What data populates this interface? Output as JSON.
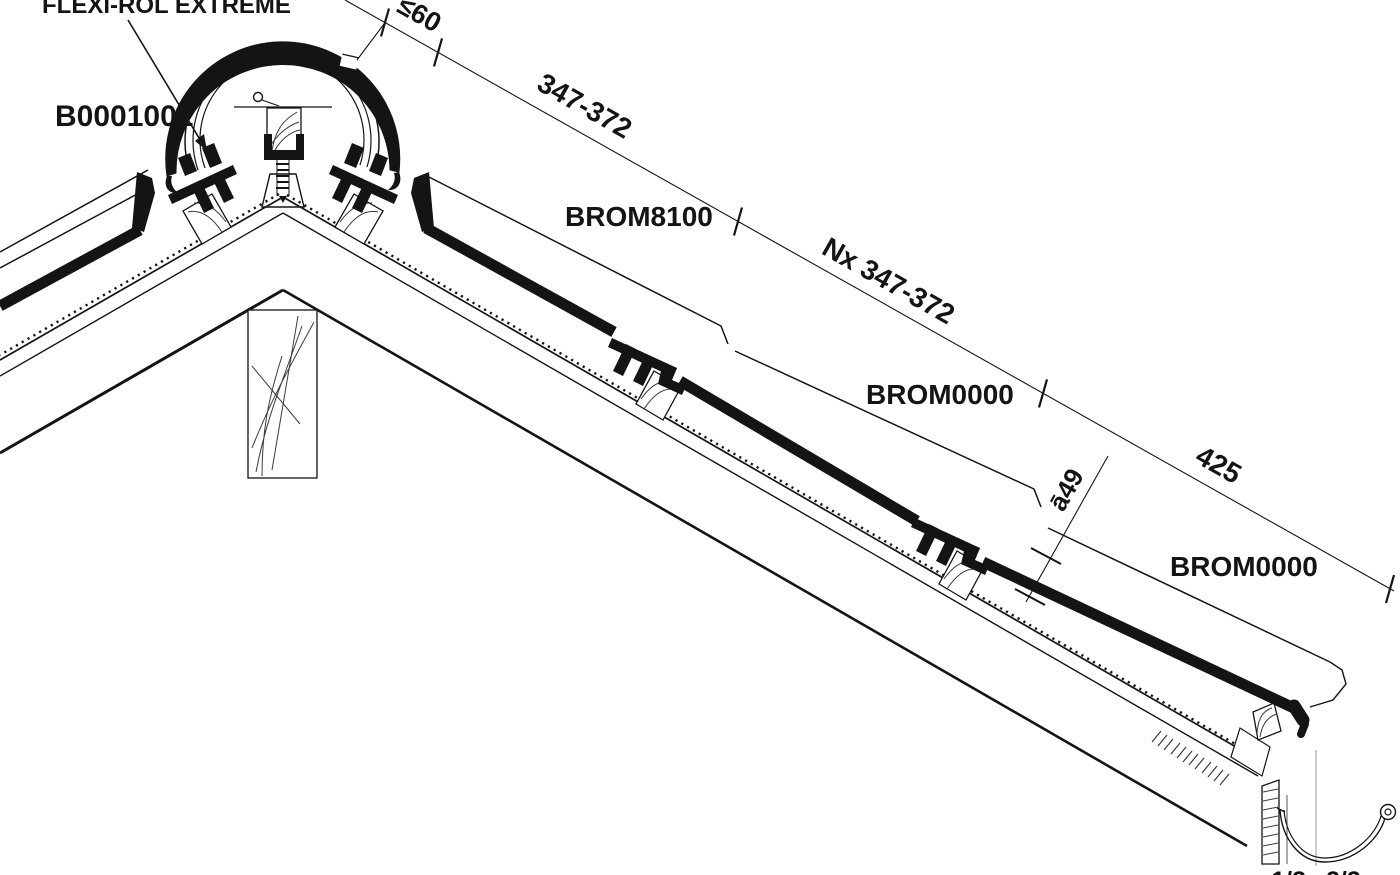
{
  "drawing": {
    "title_labels": {
      "membrane": "FLEXI-ROL EXTREME",
      "ridge_tile_code": "B0001001",
      "tile_top_code": "BROM8100",
      "tile_mid_code": "BROM0000",
      "tile_bottom_code": "BROM0000"
    },
    "dimensions": {
      "ridge_offset": "≤60",
      "top_batten_gauge": "347-372",
      "field_batten_gauge": "Nx 347-372",
      "eaves_batten_gauge": "425",
      "head_overlap": "ā49",
      "gutter_fraction_left": "1/3",
      "gutter_fraction_right": "2/3"
    },
    "colors": {
      "ink": "#141414",
      "background": "#ffffff"
    }
  }
}
